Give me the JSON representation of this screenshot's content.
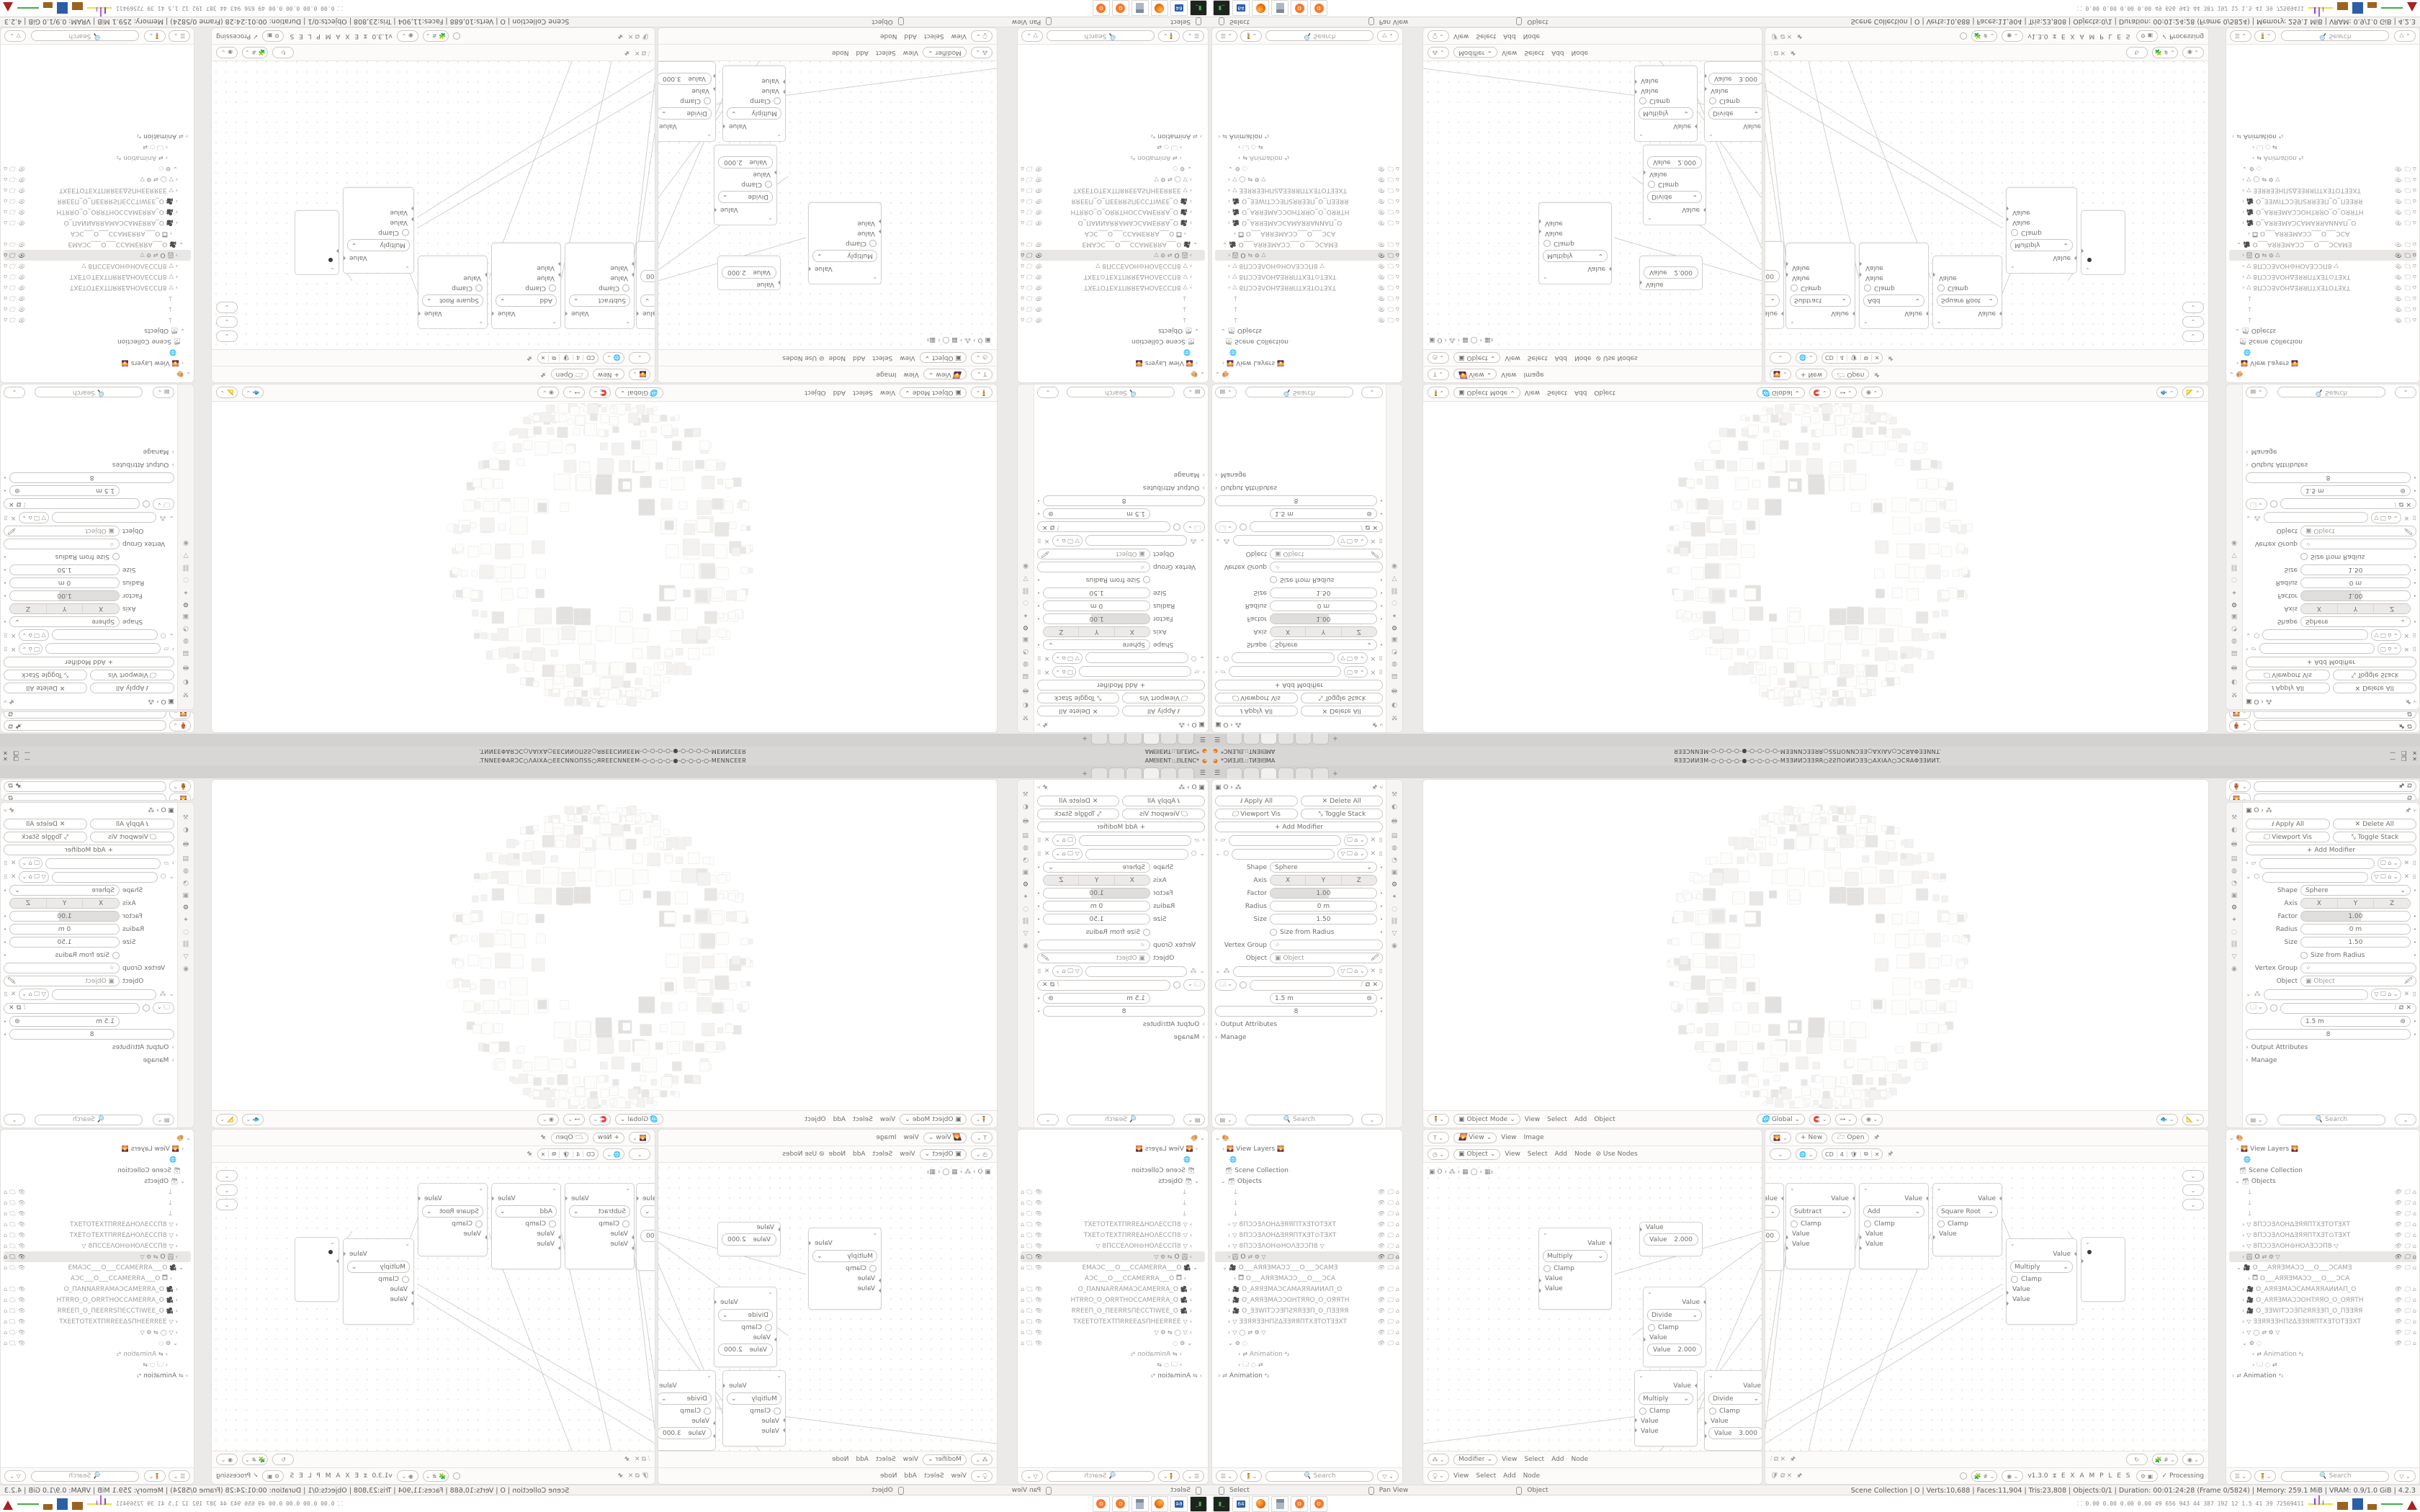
{
  "window": {
    "title_left": "*ϽͶƎ⅃ᗺ.::TͶƎIᗺMA",
    "title_center": "ЯƎƎϽͶИƎM-○-○-○-○-●-○-○-○-○-MƎƎͶͶϽƎƎЯR○ƧƧΠOͶͶϽƎƎ○AXIAΛ○ϽϹЯAΦƎƎͶͶT.",
    "minimize": "—",
    "maximize": "❐",
    "close": "✕"
  },
  "properties": {
    "breadcrumb": "▣  O  ›  ⁂",
    "apply_all": "Apply All",
    "delete_all": "Delete All",
    "viewport_vis": "Viewport Vis",
    "toggle_stack": "Toggle Stack",
    "add_modifier": "Add Modifier",
    "shape_label": "Shape",
    "shape_value": "Sphere",
    "axis_label": "Axis",
    "axis_x": "X",
    "axis_y": "Y",
    "axis_z": "Z",
    "factor_label": "Factor",
    "factor_value": "1.00",
    "radius_label": "Radius",
    "radius_value": "0 m",
    "size_label": "Size",
    "size_value": "1.50",
    "size_from_radius": "Size from Radius",
    "vertex_group_label": "Vertex Group",
    "object_label": "Object",
    "object_placeholder": "Object",
    "spacing_value": "1.5 m",
    "count_value": "8",
    "output_attributes": "Output Attributes",
    "manage": "Manage",
    "search_placeholder": "Search"
  },
  "outliner": {
    "view_layers": "View Layers",
    "scene_collection": "Scene Collection",
    "objects": "Objects",
    "name1": "8ПϽƆƎΛOHΔƎЯЯПTXƎTOTƎXT",
    "name2": "8ПϽƆƎΛOHΔƎЯЯПTXƎT⊙TƎXT",
    "name3": "8ПϽƆƎΛOH⊖HOΛƎƆϽП8",
    "sel_name": "O",
    "cam1": "O___AЯЯƎMAϽƆ___O___ϽCAMƎ",
    "cam1child": "O___AЯЯƎMAϽƆ___O___ϽCA",
    "cam2": "O_AЯЯƎMAϽCAMAЯЯAͶͶAП_O",
    "cam3": "O_AЯЯƎMAϽƆOHTЯЯO_O_OЯЯTH",
    "cam4": "O_ƎƎWITϽƆƎПƧЯЯƎƎП_O_ПƎƎЯЯ",
    "tex1": "ƎƎЯЯƎƎHПƧΔƎƎЯЯПTXƎTOTƎƎXT",
    "animation": "Animation",
    "search_placeholder": "Search"
  },
  "viewport": {
    "mode": "Object Mode",
    "menu_view": "View",
    "menu_select": "Select",
    "menu_add": "Add",
    "menu_object": "Object",
    "orientation": "Global"
  },
  "image_editor": {
    "mode": "View",
    "menu_view": "View",
    "menu_image": "Image",
    "new_label": "New",
    "open_label": "Open"
  },
  "texture_editor": {
    "mode": "Object",
    "menu_view": "View",
    "menu_select": "Select",
    "menu_add": "Add",
    "menu_node": "Node",
    "use_nodes": "Use Nodes",
    "breadcrumb": "▣ O  ›  ⁂   ›  ▦ ◯  ›  ▦₃"
  },
  "geo_editor": {
    "tree_name": "CD",
    "users": "4",
    "mode": "Modifier",
    "menu_view": "View",
    "menu_select": "Select",
    "menu_add": "Add",
    "menu_node": "Node",
    "version": "v1.3.0",
    "examples": "E X A M P L E S",
    "processing": "Processing"
  },
  "nodes": {
    "value_label": "Value",
    "clamp_label": "Clamp",
    "cluster": {
      "n0_op": "Multiply",
      "n1_val": "2.000",
      "n2_op": "Divide",
      "n2_val": "2.000",
      "n3_op": "Multiply",
      "n4_op": "Divide",
      "n4_val": "3.000",
      "partial_val": "1.00"
    },
    "chain": {
      "c1_op": "Subtract",
      "c2_op": "Add",
      "c3_op": "Square Root",
      "c4_op": "Multiply"
    }
  },
  "status": {
    "hint_select": "Select",
    "hint_pan": "Pan View",
    "hint_object": "Object",
    "stats": "Scene Collection | O | Verts:10,688 | Faces:11,904 | Tris:23,808 | Objects:0/1 | Duration: 00:01:24:28 (Frame 0/5824) | Memory: 259.1 MiB | VRAM: 0.9/1.0 GiB | 4.2.3"
  },
  "taskbar": {
    "monitor": "⸬  0.00 0.00 0.00 0.00   49   656   943   44   387   192   12   1.5   41   39   72569411",
    "floppy": "64"
  }
}
